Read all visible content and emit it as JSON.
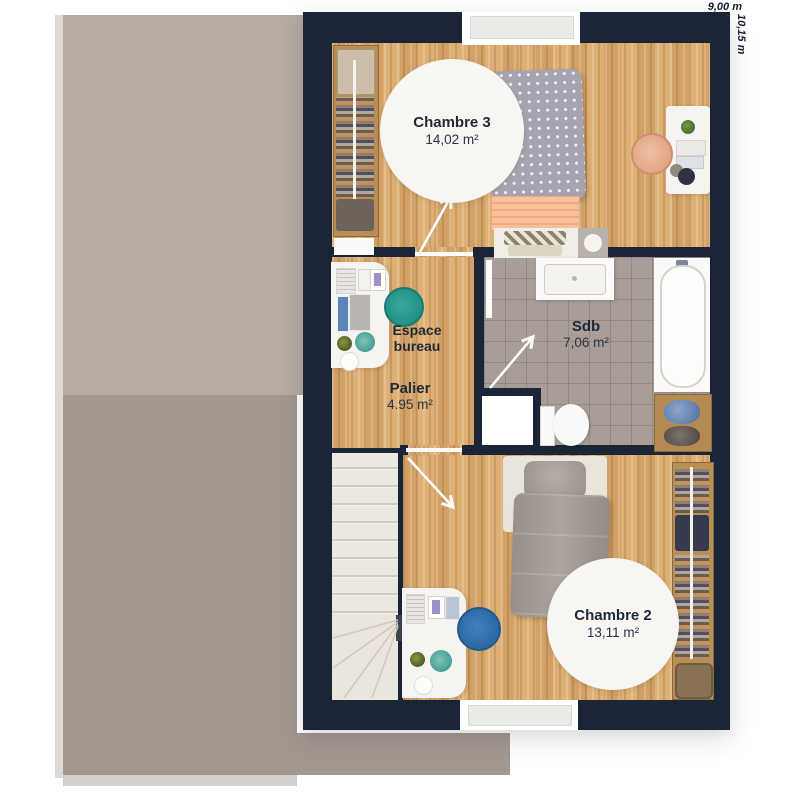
{
  "title": "Plan d'étage",
  "dimensions": {
    "width_label": "9,00 m",
    "height_label": "10,15 m"
  },
  "rooms": {
    "chambre3": {
      "name": "Chambre 3",
      "area": "14,02 m²"
    },
    "sdb": {
      "name": "Sdb",
      "area": "7,06 m²"
    },
    "palier": {
      "name": "Palier",
      "area": "4.95 m²"
    },
    "espace_bureau": {
      "name": "Espace bureau"
    },
    "chambre2": {
      "name": "Chambre 2",
      "area": "13,11 m²"
    }
  },
  "colors": {
    "wall": "#1a2638",
    "wood_floor": "#dcaa6c",
    "tile_floor": "#a89e97",
    "roof_upper": "#b6aaa1",
    "roof_lower": "#a3988f",
    "label_text": "#1f2a38"
  }
}
